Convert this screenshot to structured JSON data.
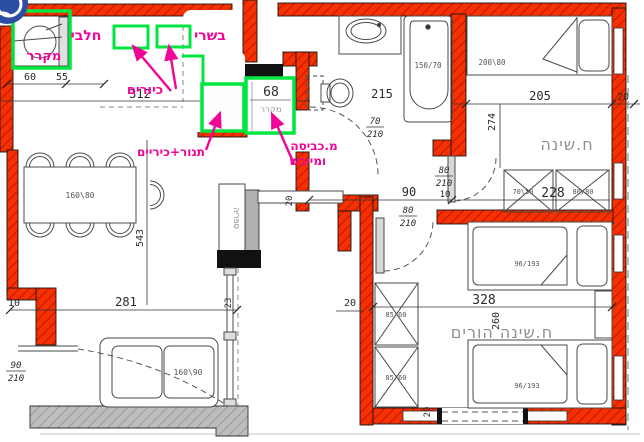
{
  "colors": {
    "wall_red": "#f63000",
    "highlight_green": "#00e640",
    "annotation_pink": "#f00596",
    "logo_blue": "#2b4ea2",
    "existing_wall_gray": "#b9b9b9"
  },
  "annotations": {
    "fridge_top": "מקרר",
    "dairy": "חלבי",
    "meat": "בשרי",
    "sinks": "כיורים",
    "oven_stove": "תנור+כיריים",
    "laundry_line1": "מ.כביסה",
    "laundry_line2": "ומייבש"
  },
  "highlight_box": {
    "number": "68",
    "label": "מקרר"
  },
  "rooms": {
    "bedroom": "ח.שינה",
    "master_bedroom": "ח.שינה הורים",
    "bookcase": "ספריה"
  },
  "furniture": {
    "table": "160\\80",
    "sofa": "160\\90",
    "bed_single": "200\\80",
    "bathtub": "150/70",
    "closet_small": "70\\50",
    "closet_square": "80/80",
    "closet_master": "85/60",
    "bed_master": "96/193"
  },
  "dimensions": {
    "d60": "60",
    "d55": "55",
    "d312": "312",
    "d215": "215",
    "d205": "205",
    "d20": "20",
    "d274": "274",
    "d228": "228",
    "d90": "90",
    "d10": "10",
    "d543": "543",
    "d281": "281",
    "d23": "23",
    "d328": "328",
    "d260": "260"
  },
  "doors": {
    "bath": {
      "num": "70",
      "den": "210"
    },
    "bedroom": {
      "num": "80",
      "den": "210"
    },
    "master": {
      "num": "80",
      "den": "210"
    },
    "entry": {
      "num": "90",
      "den": "210"
    }
  }
}
